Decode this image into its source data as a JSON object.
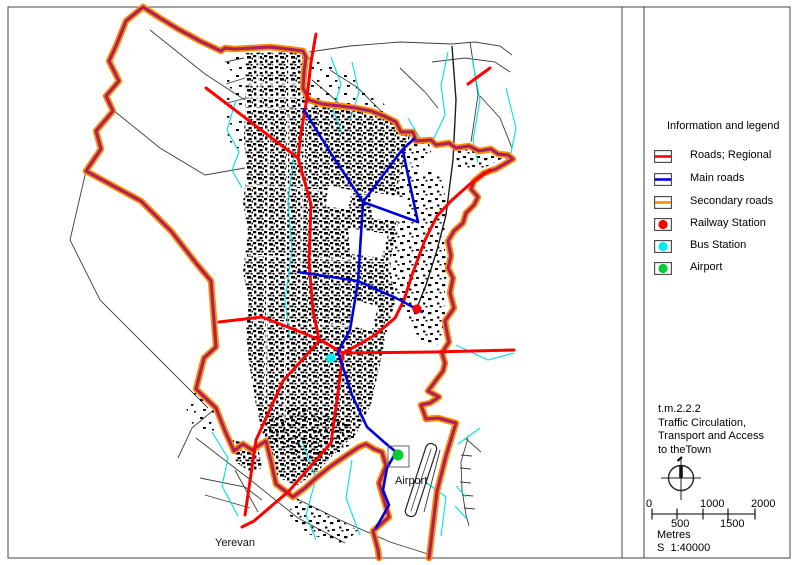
{
  "map": {
    "labels": {
      "airport": "Airport",
      "yerevan": "Yerevan"
    },
    "colors": {
      "boundary_outer": "#ff8c00",
      "boundary_inner": "#a81f62",
      "road_regional": "#ff0000",
      "road_main": "#0000dd",
      "road_secondary": "#ff8c00",
      "stream": "#00e0e0",
      "minor_road": "#3d3d3d",
      "building": "#000000",
      "railway_station": "#ff0000",
      "bus_station": "#00eeee",
      "airport": "#00cc33"
    }
  },
  "legend": {
    "title": "Information and legend",
    "items": [
      {
        "label": "Roads; Regional",
        "color": "#ff0000",
        "swatch": "line"
      },
      {
        "label": "Main roads",
        "color": "#0000dd",
        "swatch": "line"
      },
      {
        "label": "Secondary roads",
        "color": "#ff8c00",
        "swatch": "line"
      },
      {
        "label": "Railway Station",
        "color": "#ff0000",
        "swatch": "dot"
      },
      {
        "label": "Bus Station",
        "color": "#00eeee",
        "swatch": "dot"
      },
      {
        "label": "Airport",
        "color": "#00cc33",
        "swatch": "dot"
      }
    ]
  },
  "title_block": {
    "code": "t.m.2.2.2",
    "line1": "Traffic Circulation,",
    "line2": "Transport and Access",
    "line3": "to theTown"
  },
  "scale_bar": {
    "top_labels": [
      "0",
      "1000",
      "2000"
    ],
    "bottom_labels": [
      "500",
      "1500"
    ],
    "unit_label": "Metres",
    "ratio_label": "S  1:40000"
  }
}
